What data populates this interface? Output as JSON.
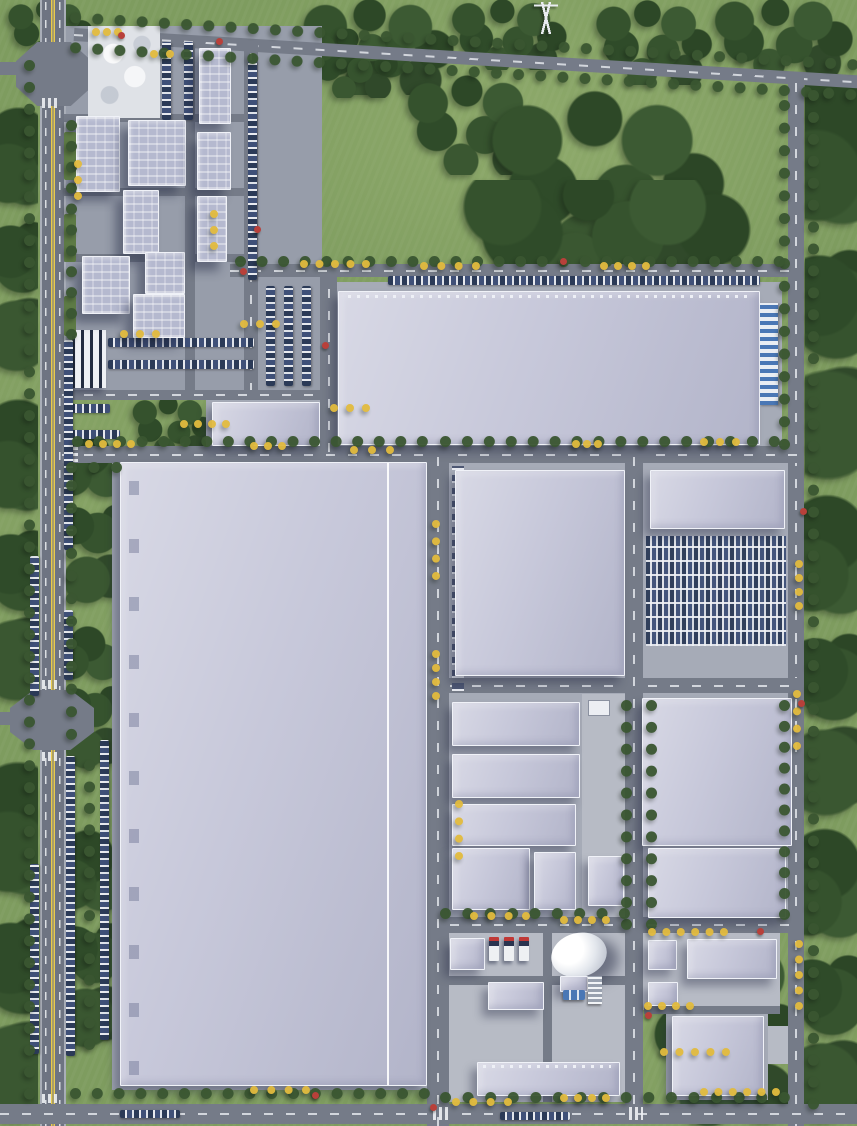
{
  "meta": {
    "view": "top-down aerial 3D rendering",
    "subject": "industrial park master plan",
    "width_px": 857,
    "height_px": 1126,
    "visible_text": ""
  },
  "palette": {
    "grass": "#7e9c5f",
    "grass_light": "#96b073",
    "tree_green": "#3a5631",
    "tree_green_dark": "#2d4827",
    "autumn_yellow": "#e2bb3e",
    "autumn_red": "#b8403a",
    "asphalt": "#757b88",
    "asphalt_main": "#6e7482",
    "sidewalk": "#a9aeb8",
    "concrete": "#b7bbc5",
    "roof_warehouse": "#c7c8da",
    "roof_office": "#b5b9cf",
    "parapet_white": "#f0f2f8",
    "plaza_paving": "#dfe2e7",
    "car_dark_blue": "#2b3a57",
    "dock_door_blue": "#4a77b5",
    "truck_cab_red": "#c03836",
    "lane_yellow": "#e8ca4c",
    "lane_white": "#eef0f4"
  },
  "zones": {
    "green_field": {
      "label": "north green field with tree clusters",
      "power_pylon_count": 1
    },
    "office_campus": {
      "label": "office campus with entrance plaza",
      "building_count": 9,
      "has_drop_off_plaza": true,
      "parking_canopy_count": 1,
      "surface_parking_lots": 3
    },
    "north_warehouse": {
      "label": "north logistics warehouse",
      "loading_dock_side": "east",
      "dock_color": "#4a77b5",
      "roadside_parking_row": true
    },
    "small_warehouse": {
      "label": "small warehouse near campus"
    },
    "west_mega_warehouse": {
      "label": "west mega warehouse",
      "roof_ridge": "white longitudinal line"
    },
    "central_workshops": {
      "label": "central workshop cluster",
      "building_count": 7
    },
    "east_block": {
      "label": "east block",
      "building_count": 3,
      "staff_parking_rows": 8
    },
    "utility_yard": {
      "label": "utility yard",
      "dome_tank_count": 1,
      "truck_bay_count": 3,
      "equipment": [
        "heat-exchanger-rack",
        "blue-pump-skids"
      ]
    },
    "southeast_sheds": {
      "label": "southeast shed cluster",
      "building_count": 4
    }
  },
  "roads": {
    "main_road_west": {
      "label": "main avenue west",
      "center_line": "double yellow",
      "street_parking": true
    },
    "perimeter_road_north": {
      "label": "perimeter road north (diagonal)"
    },
    "perimeter_road_east": {
      "label": "perimeter road east"
    },
    "ring_road_south": {
      "label": "south boundary road"
    },
    "internal_roads": {
      "label": "internal grid roads",
      "marking": "white dashed"
    },
    "junction_count": 2
  }
}
